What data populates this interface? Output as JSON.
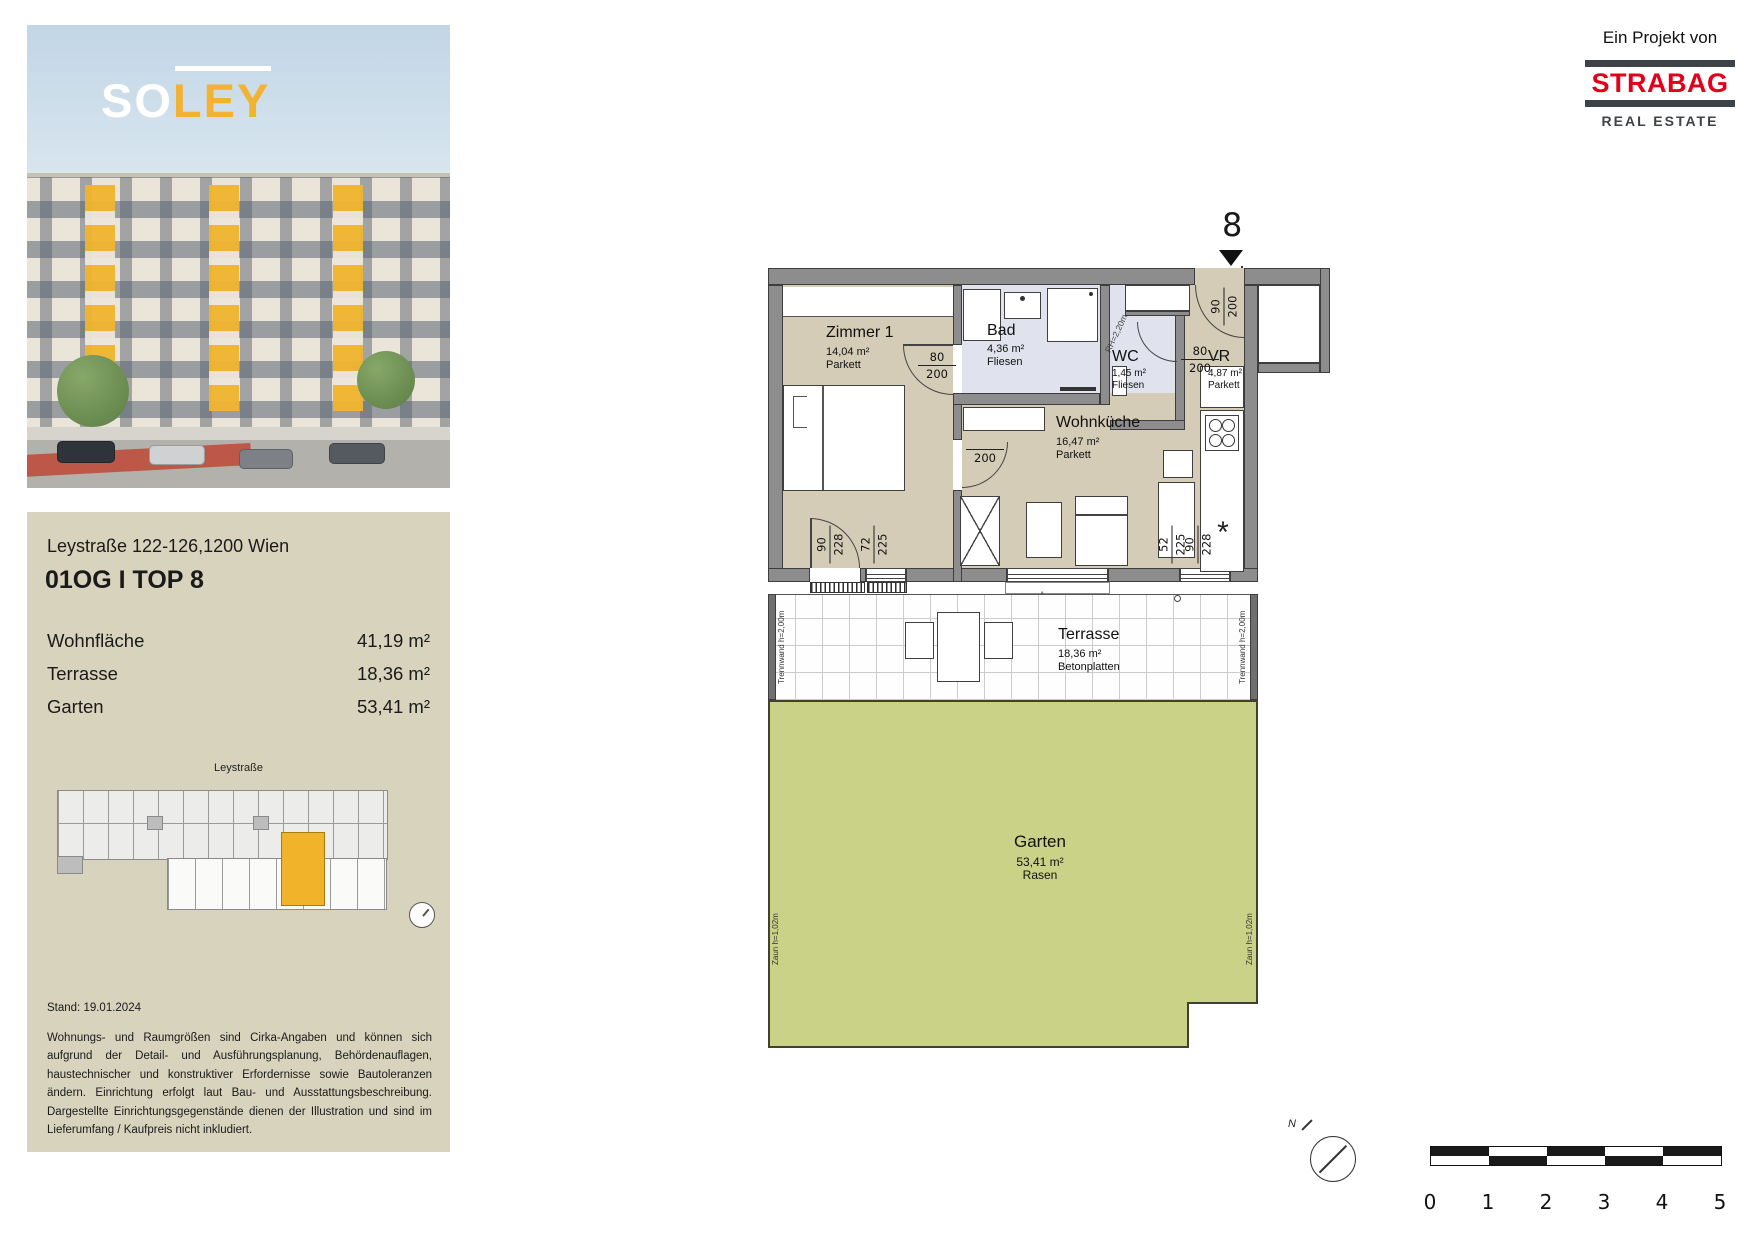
{
  "branding": {
    "project_label": "Ein Projekt von",
    "brand_name": "STRABAG",
    "brand_subtitle": "REAL ESTATE",
    "brand_red": "#E2001A",
    "bar_color": "#3E4347"
  },
  "logo": {
    "part_white": "SO",
    "part_yellow": "LEY",
    "accent_yellow": "#F2B233"
  },
  "info_panel": {
    "address": "Leystraße 122-126,1200 Wien",
    "unit_title": "01OG I TOP 8",
    "metrics": [
      {
        "label": "Wohnfläche",
        "value": "41,19 m²"
      },
      {
        "label": "Terrasse",
        "value": "18,36 m²"
      },
      {
        "label": "Garten",
        "value": "53,41 m²"
      }
    ],
    "siteplan_street": "Leystraße",
    "stand": "Stand: 19.01.2024",
    "disclaimer": "Wohnungs- und Raumgrößen sind Cirka-Angaben und können sich aufgrund der Detail- und Ausführungsplanung, Behördenauflagen, haustechnischer und konstruktiver Erfordernisse sowie Bautoleranzen ändern. Einrichtung erfolgt laut Bau- und Ausstattungsbeschreibung. Dargestellte Einrichtungsgegenstände dienen der Illustration und sind im Lieferumfang / Kaufpreis nicht inkludiert."
  },
  "floorplan": {
    "unit_number": "8",
    "rooms": [
      {
        "name": "Zimmer 1",
        "area": "14,04 m²",
        "floor": "Parkett"
      },
      {
        "name": "Bad",
        "area": "4,36 m²",
        "floor": "Fliesen"
      },
      {
        "name": "WC",
        "area": "1,45 m²",
        "floor": "Fliesen"
      },
      {
        "name": "VR",
        "area": "4,87 m²",
        "floor": "Parkett"
      },
      {
        "name": "Wohnküche",
        "area": "16,47 m²",
        "floor": "Parkett"
      },
      {
        "name": "Terrasse",
        "area": "18,36 m²",
        "floor": "Betonplatten"
      },
      {
        "name": "Garten",
        "area": "53,41 m²",
        "floor": "Rasen"
      }
    ],
    "dims": {
      "entry": {
        "w": "90",
        "h": "200"
      },
      "zimmer1_door": {
        "w": "80",
        "h": "200"
      },
      "wohnkueche_door": {
        "w": "80",
        "h": "200"
      },
      "wc_door": {
        "w": "80",
        "h": "200"
      },
      "terrace_door": {
        "w": "90",
        "h": "228"
      },
      "zimmer1_window": {
        "w": "72",
        "h": "225"
      },
      "sliding_door": {
        "w": "160",
        "h": "126"
      },
      "kitchen_window": {
        "w": "52",
        "h": "225"
      },
      "kitchen_door": {
        "w": "90",
        "h": "228"
      }
    },
    "annotations": {
      "rh": "RH=2,20m",
      "trennwand": "Trennwand h=2,00m",
      "zaun": "Zaun h=1,02m",
      "north": "N",
      "sink_symbol": "*"
    },
    "colors": {
      "wall_gray": "#8D8D8D",
      "floor_beige": "#D4CCB6",
      "wet_blue": "#E0E3ED",
      "garden_green": "#C9D287",
      "highlight_orange": "#F0B32A"
    }
  },
  "scalebar": {
    "labels": [
      "0",
      "1",
      "2",
      "3",
      "4",
      "5"
    ]
  }
}
